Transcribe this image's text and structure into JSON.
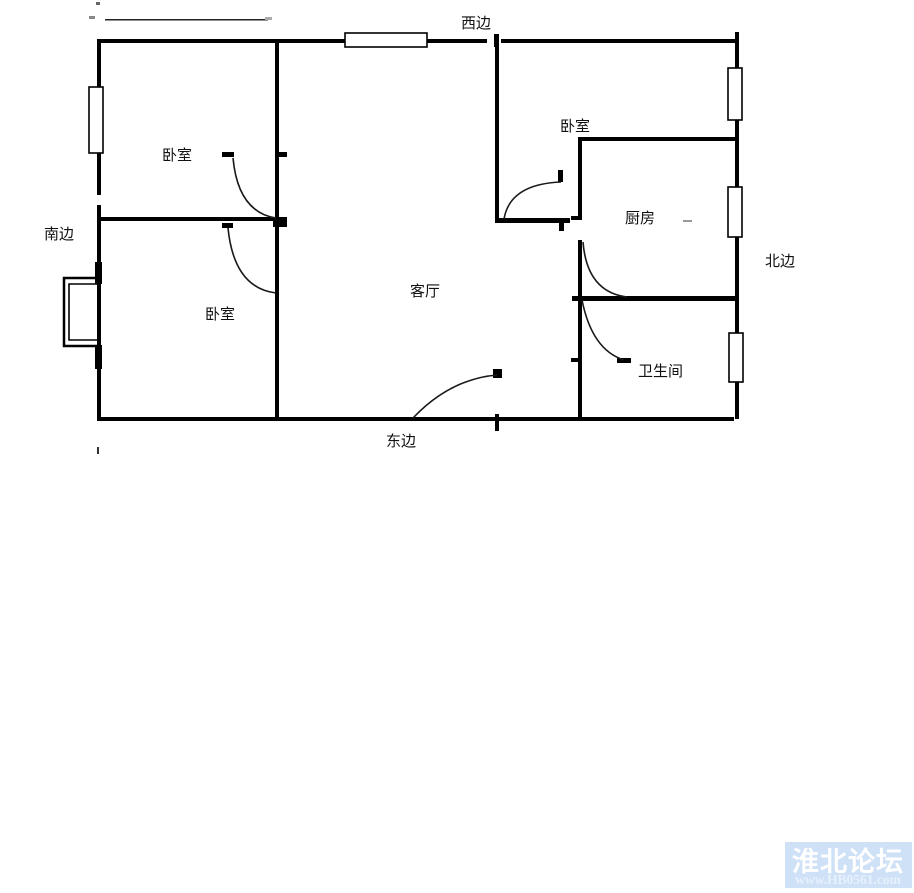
{
  "diagram": {
    "type": "apartment-floor-plan",
    "room_labels": {
      "bedroom_upper_left": "卧室",
      "bedroom_lower_left": "卧室",
      "bedroom_top_right": "卧室",
      "living_room": "客厅",
      "kitchen": "厨房",
      "bathroom": "卫生间"
    },
    "direction_labels": {
      "west": "西边",
      "south": "南边",
      "north": "北边",
      "east": "东边"
    }
  },
  "watermark": {
    "site_name": "淮北论坛",
    "site_url": "www.HB0561.com",
    "bg_color": "#cfe1f7",
    "title_color": "#ffffff",
    "url_color": "#e8f1fd"
  },
  "colors": {
    "background": "#ffffff",
    "wall": "#000000"
  }
}
